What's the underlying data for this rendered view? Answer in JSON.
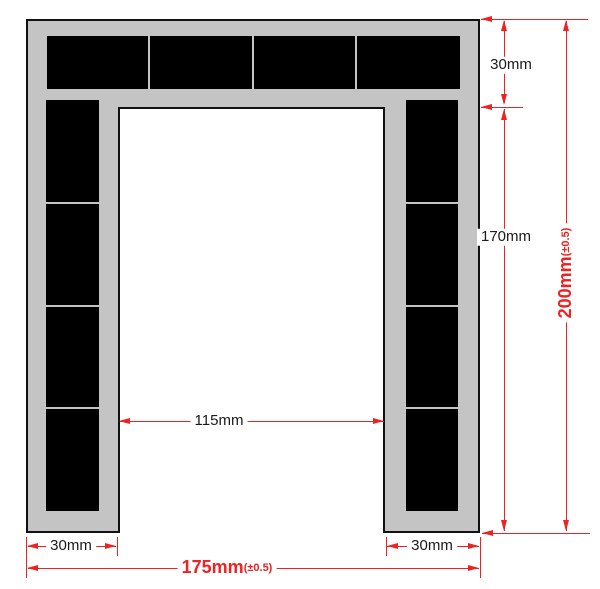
{
  "diagram": {
    "type": "dimensioned-drawing",
    "shape": "u-frame with black panels",
    "labels": {
      "top_thickness": "30mm",
      "right_height": "170mm",
      "total_height_value": "200mm",
      "total_height_tolerance": "(±0.5)",
      "inner_width": "115mm",
      "left_leg_width": "30mm",
      "right_leg_width": "30mm",
      "total_width_value": "175mm",
      "total_width_tolerance": "(±0.5)"
    },
    "colors": {
      "frame_fill": "#c4c4c4",
      "panel_fill": "#000000",
      "outline": "#111111",
      "dimension_red": "#ee2222",
      "label_black": "#1a1a1a",
      "background": "#ffffff"
    }
  }
}
